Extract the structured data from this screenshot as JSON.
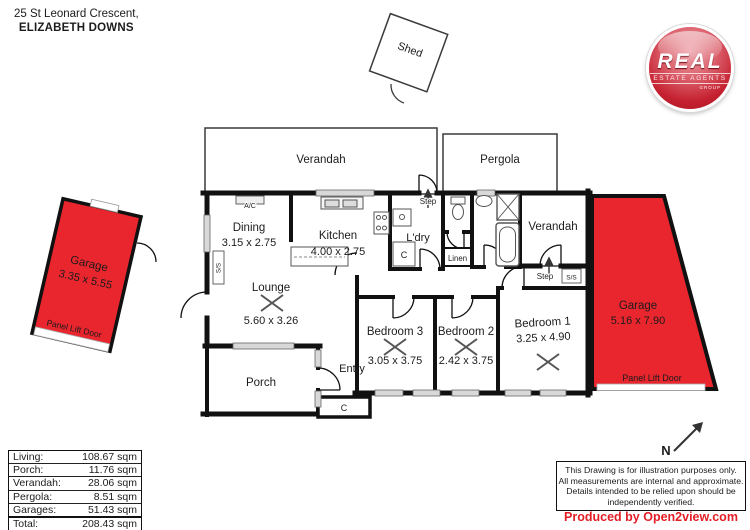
{
  "address": {
    "line1": "25 St Leonard Crescent,",
    "line2": "ELIZABETH DOWNS"
  },
  "logo": {
    "name": "REAL",
    "sub": "ESTATE AGENTS",
    "group": "GROUP"
  },
  "plan": {
    "verandah_top": "Verandah",
    "pergola": "Pergola",
    "verandah_right": "Verandah",
    "shed": "Shed",
    "dining": {
      "name": "Dining",
      "dims": "3.15 x 2.75"
    },
    "kitchen": {
      "name": "Kitchen",
      "dims": "4.00 x 2.75"
    },
    "laundry": {
      "name": "L'dry"
    },
    "lounge": {
      "name": "Lounge",
      "dims": "5.60 x 3.26"
    },
    "porch": {
      "name": "Porch"
    },
    "entry": {
      "name": "Entry"
    },
    "bedroom3": {
      "name": "Bedroom 3",
      "dims": "3.05 x 3.75"
    },
    "bedroom2": {
      "name": "Bedroom 2",
      "dims": "2.42 x 3.75"
    },
    "bedroom1": {
      "name": "Bedroom 1",
      "dims": "3.25 x 4.90"
    },
    "garage_left": {
      "name": "Garage",
      "dims": "3.35 x 5.55",
      "door": "Panel Lift Door"
    },
    "garage_right": {
      "name": "Garage",
      "dims": "5.16 x 7.90",
      "door": "Panel Lift Door"
    },
    "labels": {
      "step": "Step",
      "ss": "S/S",
      "linen": "Linen",
      "cupboard": "C",
      "ac": "A/C",
      "north": "N"
    }
  },
  "areas": {
    "rows": [
      {
        "label": "Living:",
        "value": "108.67 sqm"
      },
      {
        "label": "Porch:",
        "value": "11.76 sqm"
      },
      {
        "label": "Verandah:",
        "value": "28.06 sqm"
      },
      {
        "label": "Pergola:",
        "value": "8.51 sqm"
      },
      {
        "label": "Garages:",
        "value": "51.43 sqm"
      }
    ],
    "total": {
      "label": "Total:",
      "value": "208.43 sqm"
    }
  },
  "disclaimer": {
    "line1": "This Drawing is for illustration purposes only.",
    "line2": "All measurements are internal and approximate.",
    "line3": "Details intended to be relied upon should be",
    "line4": "independently verified."
  },
  "credit": "Produced by Open2view.com",
  "colors": {
    "garage_red": "#e9252d",
    "credit_red": "#e31e26"
  }
}
